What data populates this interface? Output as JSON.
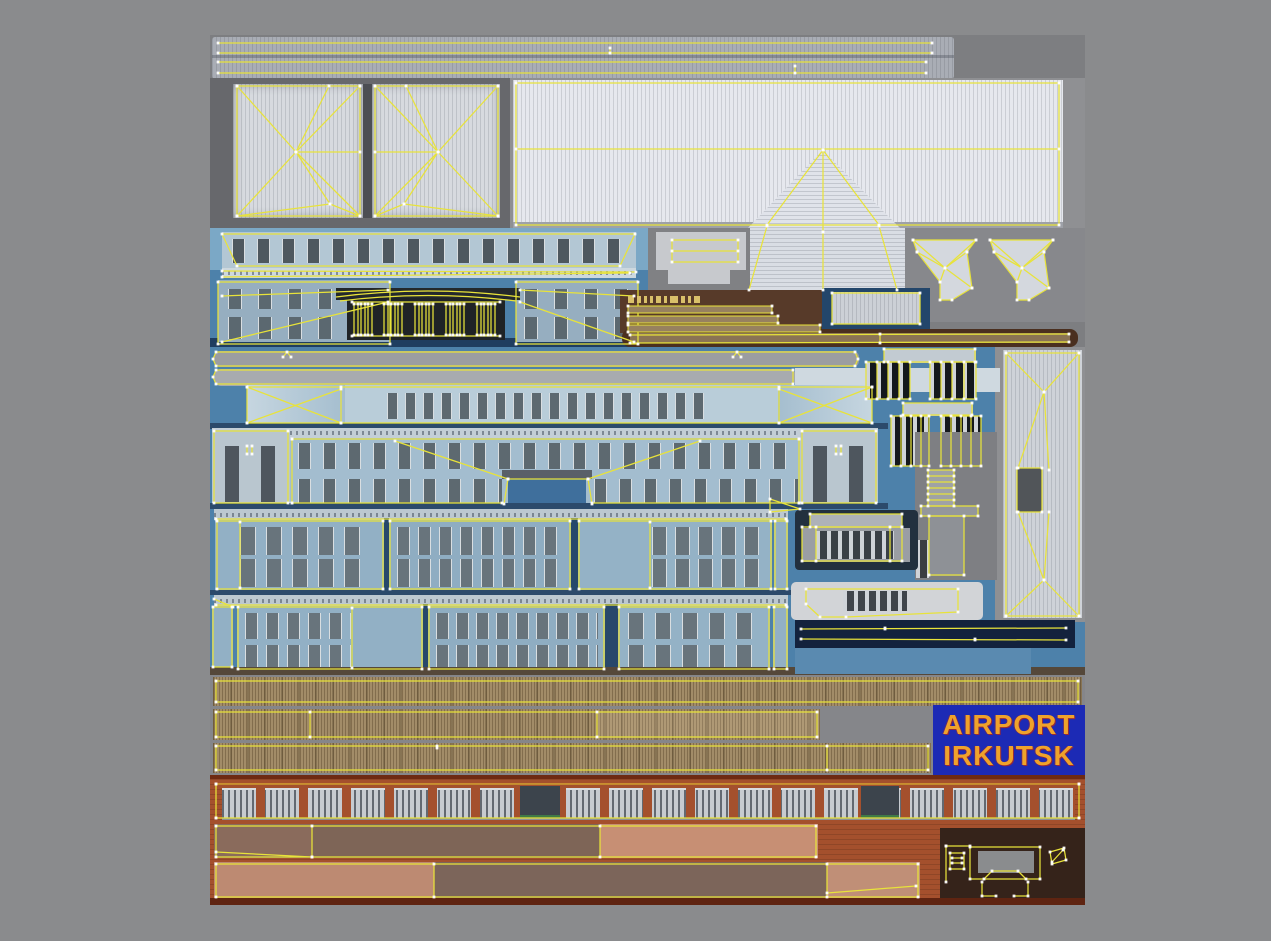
{
  "title": "airport-irkutsk-texture-atlas",
  "sign": {
    "line1": "AIRPORT",
    "line2": "IRKUTSK"
  },
  "colors": {
    "outer_bg": "#8a8b8d",
    "atlas_bg": "#7d7e81",
    "panel_dark_gray": "#67686c",
    "roof_light": "#e2e4ea",
    "uv_yellow": "#e8e33a",
    "blue_panel": "#4d81aa",
    "blue_panel_light": "#7ba8c6",
    "blue_panel_dark": "#1f3d60",
    "wall_blue": "#9db8cb",
    "wall_blue_light": "#b6cad8",
    "brown_panel": "#573a29",
    "tan_strip": "#97815f",
    "wood_light": "#a28c68",
    "navy_strip": "#13223d",
    "brick": "#a4502d",
    "brick_dark": "#6e2a12",
    "strip_pink": "#c18f78",
    "strip_mauve": "#7e6557",
    "sign_bg": "#1c2ab5",
    "sign_text": "#efa22b",
    "gray_light_piece": "#d2d4d7"
  }
}
